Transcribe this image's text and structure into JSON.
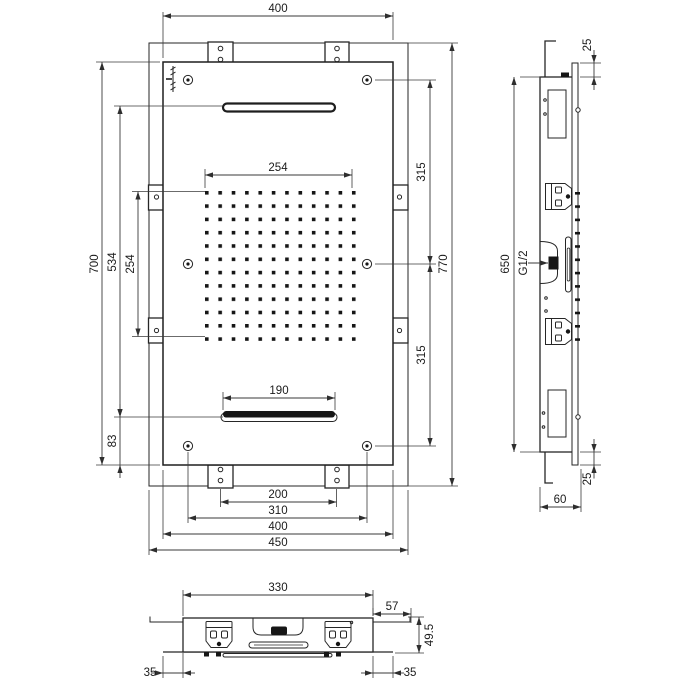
{
  "dims": {
    "front": {
      "width_top": "400",
      "height": "700",
      "slot_span": "534",
      "nozzle_field_height": "254",
      "bottom_offset": "83",
      "nozzle_field_width": "254",
      "lower_slot_width": "190",
      "hole_span_upper": "315",
      "hole_span_lower": "315",
      "total_height": "770",
      "bracket_span": "200",
      "hole_span_width": "310",
      "width_bottom": "400",
      "total_width": "450"
    },
    "side": {
      "lip_top": "25",
      "lip_bottom": "25",
      "frame_height": "650",
      "depth": "60",
      "connection": "G1/2"
    },
    "bottom": {
      "body_width": "330",
      "hook_offset": "57",
      "body_height": "49.5",
      "lip_left": "35",
      "lip_right": "35"
    }
  }
}
